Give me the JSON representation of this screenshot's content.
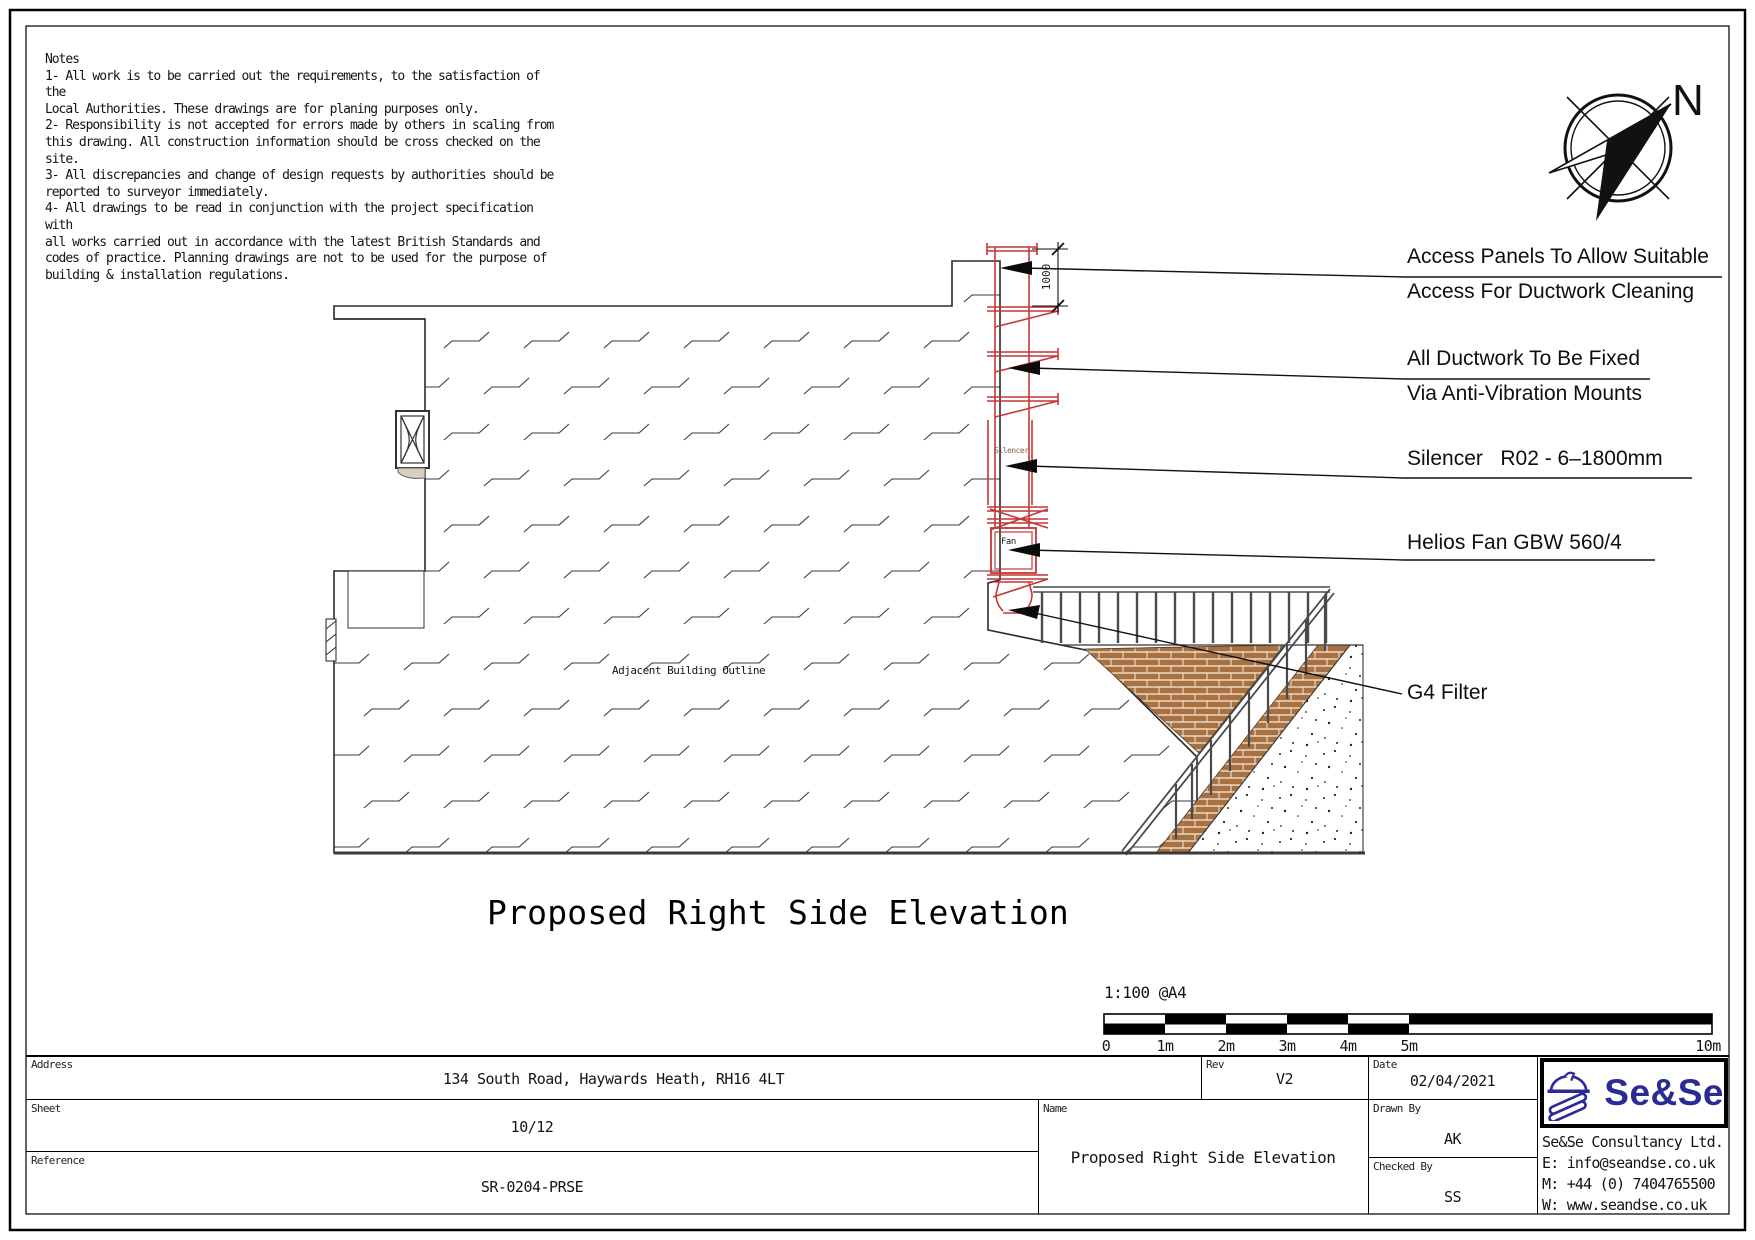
{
  "notes": {
    "text": "Notes\n1- All work is to be carried out the requirements, to the satisfaction of the\nLocal Authorities. These drawings are for planing purposes only.\n2- Responsibility is not accepted for errors made by others in scaling from\nthis drawing. All construction information should be cross checked on the site.\n3- All discrepancies and change of design requests by authorities should be\nreported to surveyor immediately.\n4- All drawings to be read in conjunction with the project specification with\nall works carried out in accordance with the latest British Standards and\ncodes of practice. Planning drawings are not to be used for the purpose of\nbuilding & installation regulations."
  },
  "compass": {
    "north_label": "N"
  },
  "annotations": {
    "access_panels_line1": "Access Panels To Allow Suitable",
    "access_panels_line2": "Access For Ductwork Cleaning",
    "ductwork_line1": "All Ductwork To Be Fixed",
    "ductwork_line2": "Via Anti-Vibration Mounts",
    "silencer": "Silencer   R02 - 6–1800mm",
    "fan": "Helios Fan GBW 560/4",
    "filter": "G4 Filter"
  },
  "drawing": {
    "adjacent_building_label": "Adjacent Building Outline",
    "duct_silencer_label": "Silencer",
    "duct_fan_label": "Fan",
    "top_dimension": "1000"
  },
  "title": "Proposed Right Side Elevation",
  "scale_bar": {
    "scale_label": "1:100 @A4",
    "ticks": [
      "0",
      "1m",
      "2m",
      "3m",
      "4m",
      "5m",
      "10m"
    ]
  },
  "title_block": {
    "address": {
      "label": "Address",
      "value": "134 South Road, Haywards Heath, RH16 4LT"
    },
    "sheet": {
      "label": "Sheet",
      "value": "10/12"
    },
    "reference": {
      "label": "Reference",
      "value": "SR-0204-PRSE"
    },
    "rev": {
      "label": "Rev",
      "value": "V2"
    },
    "date": {
      "label": "Date",
      "value": "02/04/2021"
    },
    "name": {
      "label": "Name",
      "value": "Proposed Right Side Elevation"
    },
    "drawn_by": {
      "label": "Drawn By",
      "value": "AK"
    },
    "checked_by": {
      "label": "Checked By",
      "value": "SS"
    },
    "company": {
      "logo_text": "Se&Se",
      "name": "Se&Se Consultancy Ltd.",
      "email": "E: info@seandse.co.uk",
      "mobile": "M: +44 (0) 7404765500",
      "web": "W: www.seandse.co.uk"
    }
  },
  "colors": {
    "duct_red": "#c43737",
    "brick": "#a9713f",
    "logo_blue": "#2b2b96",
    "line": "#2b2b2b"
  }
}
